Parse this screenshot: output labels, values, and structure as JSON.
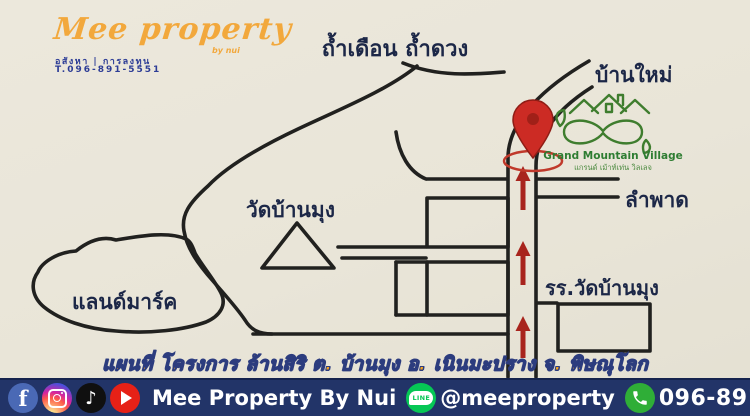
{
  "colors": {
    "paper": "#e9e5d8",
    "map_ink": "#21211f",
    "label_navy": "#1c2747",
    "pin_red": "#cc2b24",
    "arrow_red": "#a8241d",
    "village_green": "#3f7d2e",
    "caption_orange": "#f8a51f",
    "caption_outline": "#2c3c7e",
    "footer_bg": "#223468",
    "brand_orange": "#f2a83c",
    "brand_navy": "#2c3c96"
  },
  "logo": {
    "brand": "Mee property",
    "sub": "by nui",
    "tagline": "อสังหา | การลงทุน",
    "phone": "T.096-891-5551"
  },
  "map": {
    "labels": {
      "caves": "ถ้ำเดือน ถ้ำดวง",
      "ban_mai": "บ้านใหม่",
      "lam_phat": "ลำพาด",
      "wat_ban_mung": "วัดบ้านมุง",
      "landmark": "แลนด์มาร์ค",
      "school": "รร.วัดบ้านมุง"
    },
    "village_logo": {
      "name_en": "Grand Mountain Village",
      "name_th": "แกรนด์ เม้าท์เท่น วิลเลจ"
    },
    "caption": "แผนที่ โครงการ ล้านสิริ ต. บ้านมุง อ. เนินมะปราง จ. พิษณุโลก"
  },
  "footer": {
    "icons": [
      "facebook-icon",
      "instagram-icon",
      "tiktok-icon",
      "youtube-icon",
      "line-icon",
      "phone-icon"
    ],
    "brand": "Mee Property By Nui",
    "line_label": "LINE",
    "line_id": "@meeproperty",
    "phone": "096-891-5551"
  }
}
